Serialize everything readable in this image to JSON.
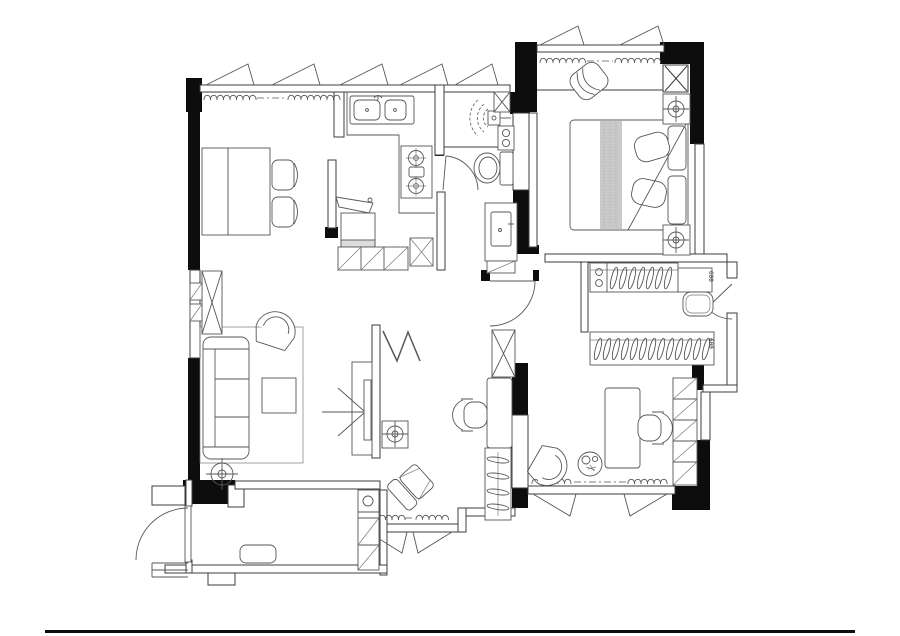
{
  "canvas": {
    "width": 900,
    "height": 636,
    "background": "#ffffff"
  },
  "colors": {
    "wall_fill": "#0d0d0d",
    "wall_line": "#3c3c3c",
    "furniture_line": "#575757",
    "bed_runner_fill": "#c9c9c9",
    "page_rule": "#111111"
  },
  "drawing": {
    "type": "apartment-floor-plan",
    "rooms": [
      {
        "id": "dining-area",
        "furniture": [
          "dining-table",
          "dining-chair",
          "dining-chair",
          "window-curtain"
        ]
      },
      {
        "id": "kitchen",
        "furniture": [
          "double-sink",
          "gas-stove",
          "washing-machine",
          "fridge",
          "base-cabinets",
          "partition-screen"
        ]
      },
      {
        "id": "bathroom",
        "furniture": [
          "shower-head",
          "water-heater",
          "shaft-box",
          "toilet",
          "vanity-sink",
          "vanity-cabinet",
          "swing-door"
        ]
      },
      {
        "id": "master-bedroom",
        "furniture": [
          "double-bed",
          "pillows",
          "nightstand",
          "nightstand",
          "ceiling-lamp",
          "ceiling-lamp",
          "tub-chair",
          "casement-window",
          "curtain"
        ]
      },
      {
        "id": "dressing-corridor",
        "furniture": [
          "wardrobe-hangers",
          "wardrobe-hangers",
          "ottoman",
          "open-shelf",
          "shoe-drawer",
          "swing-door"
        ]
      },
      {
        "id": "study",
        "furniture": [
          "desk",
          "office-chair",
          "tub-chair",
          "round-side-table",
          "bookshelf",
          "casement-window",
          "curtain"
        ]
      },
      {
        "id": "bedroom-2",
        "furniture": [
          "desk",
          "office-chair",
          "wardrobe-hangers",
          "lounge-chair",
          "floor-lamp",
          "folding-door-zigzag",
          "casement-window",
          "curtain"
        ]
      },
      {
        "id": "living-room",
        "furniture": [
          "three-seat-sofa",
          "rug",
          "coffee-table",
          "armchair",
          "floor-lamp",
          "tv-unit",
          "sight-line-arrows",
          "display-cabinet"
        ]
      },
      {
        "id": "entry-balcony",
        "furniture": [
          "entrance-door",
          "door-steps",
          "doormat",
          "shoe-cabinet",
          "threshold-step"
        ]
      }
    ],
    "dimension_labels": [
      {
        "text": "600"
      },
      {
        "text": "600"
      }
    ]
  }
}
